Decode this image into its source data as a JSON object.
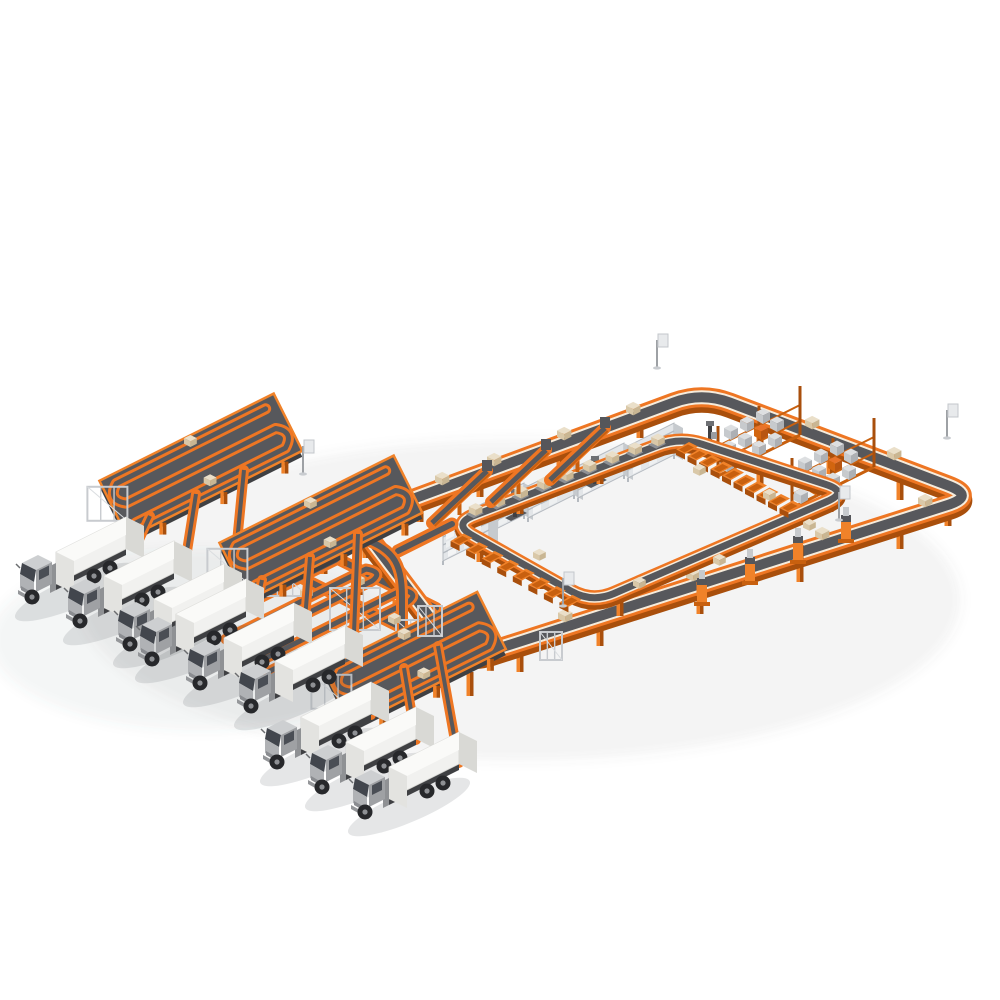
{
  "scene": {
    "kind": "isometric-3d-illustration",
    "subject": "automated parcel sortation warehouse with orange conveyor loops, storage racks and truck loading docks",
    "background": "#FFFFFF"
  },
  "palette": {
    "orange": "#EE7623",
    "orange_mid": "#F08229",
    "orange_deep": "#C8600F",
    "orange_under": "#A94F0C",
    "belt": "#57585C",
    "belt_dark": "#3F4043",
    "cream": "#F6ECDC",
    "rack_light": "#E3E6E9",
    "rack_side": "#C6CACE",
    "rack_line": "#B5BAC0",
    "steel": "#C8CBCF",
    "machine_dark": "#55565A",
    "truck_white": "#F1F1EF",
    "truck_top": "#FAFAF8",
    "truck_shade": "#D9D9D5",
    "truck_front": "#E3E3E0",
    "cab_gray": "#9FA1A4",
    "cab_light": "#CDCFD1",
    "cab_mid": "#B0B2B5",
    "glass": "#42464D",
    "tire": "#27282B",
    "hub_gray": "#8E9094",
    "parcel": "#EADFC9",
    "parcel_side": "#D9C8A8",
    "parcel_dark": "#C9B693",
    "shadow": "rgba(70,75,85,0.14)"
  },
  "inventory": {
    "delivery_trucks": 9,
    "truck_dock_groups": 3,
    "trucks_per_dock": 3,
    "dock_serpentine_conveyors": 3,
    "telescopic_boom_loaders": 9,
    "outer_conveyor_loop": 1,
    "inner_sorter_loop": 1,
    "induction_ramps": 3,
    "chutes_top_row": 10,
    "chutes_bottom_row": 8,
    "tray_carriers": 9,
    "shelving_racks": 5,
    "pallet_racks_with_totes": 2,
    "stacker_cranes": 3,
    "sorter_machines": 4,
    "hub_hairpin_conveyors": 3,
    "hub_cross_conveyors": 2,
    "support_scaffolds": 6,
    "sign_posts": 5,
    "loop_parcels": 10
  }
}
